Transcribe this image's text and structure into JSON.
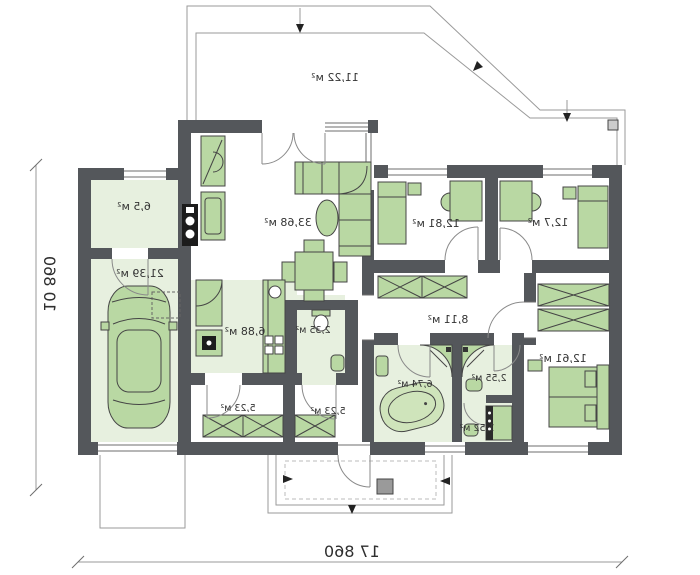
{
  "floor_plan": {
    "dimensions": {
      "width": "17 860",
      "height": "10 860"
    },
    "terrace": {
      "name": "terrace",
      "area": "11,22 м²"
    },
    "rooms": [
      {
        "name": "utility-room",
        "area": "6,5 м²"
      },
      {
        "name": "garage",
        "area": "21,39 м²"
      },
      {
        "name": "living-room",
        "area": "33,68 м²"
      },
      {
        "name": "kitchen",
        "area": "6,88 м²"
      },
      {
        "name": "wc",
        "area": "2,35 м²"
      },
      {
        "name": "hall-left",
        "area": "5,23 м²"
      },
      {
        "name": "hall-right",
        "area": "5,23 м²"
      },
      {
        "name": "corridor",
        "area": "8,11 м²"
      },
      {
        "name": "bathroom",
        "area": "6,74 м²"
      },
      {
        "name": "shower-room",
        "area": "2,55 м²"
      },
      {
        "name": "laundry",
        "area": "1,52 м²"
      },
      {
        "name": "bedroom-1",
        "area": "12,81 м²"
      },
      {
        "name": "bedroom-2",
        "area": "12,7 м²"
      },
      {
        "name": "bedroom-3",
        "area": "12,61 м²"
      }
    ],
    "colors": {
      "wall": "#54575b",
      "room_fill": "#e7f0df",
      "furniture_fill": "#b9d8a3",
      "furniture_stroke": "#454545",
      "thin_line": "#9a9a9a",
      "text": "#333333"
    },
    "notes": {
      "mirrored": "plan rendered horizontally mirrored as in source image"
    }
  }
}
